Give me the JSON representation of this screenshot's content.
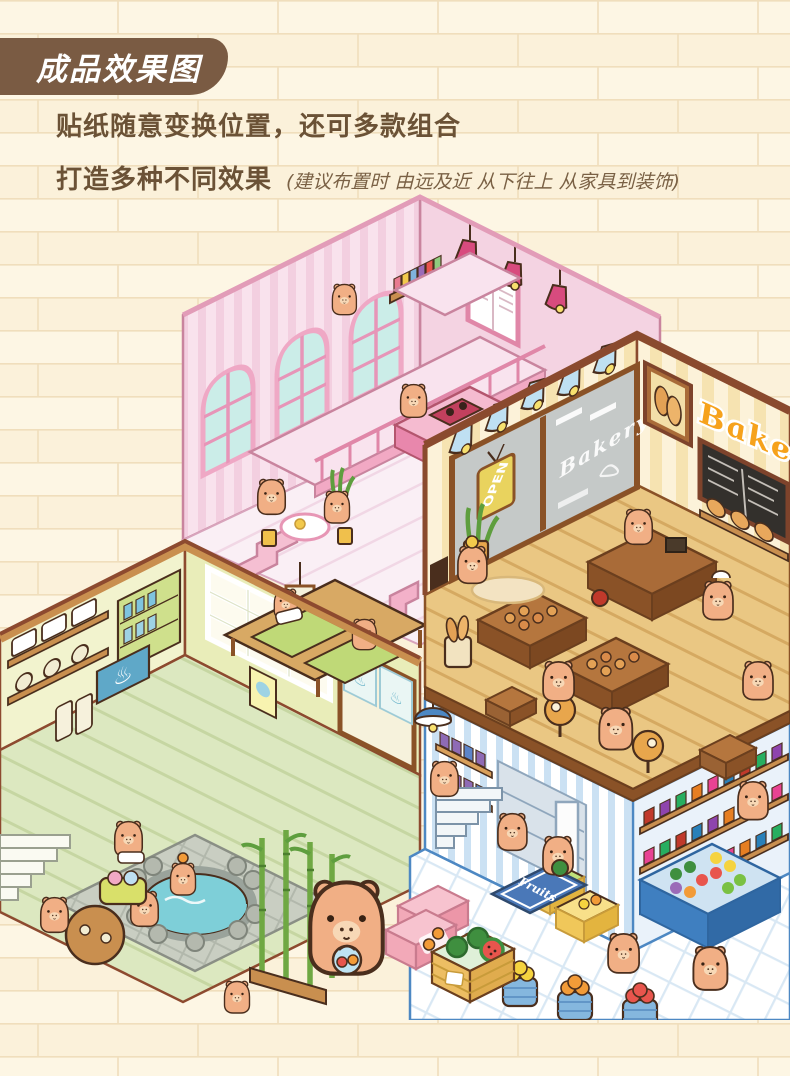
{
  "header": {
    "badge": "成品效果图"
  },
  "description": {
    "line1": "贴纸随意变换位置，还可多款组合",
    "line2": "打造多种不同效果",
    "note": "(建议布置时 由远及近 从下往上 从家具到装饰)"
  },
  "illustration": {
    "bakery": {
      "wall_sign": "Bakery",
      "window_sign": "Bakery",
      "open_sign": "OPEN"
    },
    "market": {
      "mat_sign": "Fruits"
    },
    "onsen": {
      "symbol": "♨"
    },
    "colors": {
      "background": "#FCF4DF",
      "brick_line": "#F0DEBC",
      "badge_brown": "#7A5B43",
      "text_brown": "#6B5236",
      "restaurant_pink": "#F8DFEA",
      "restaurant_accent": "#F19CBB",
      "bakery_cream": "#FBF1D9",
      "bakery_orange": "#F6A21C",
      "bakery_wood": "#A96B38",
      "onsen_green": "#EDF0C6",
      "market_blue": "#CBE1F3",
      "market_accent": "#3F7FC0",
      "capybara": "#F1AF85"
    }
  }
}
